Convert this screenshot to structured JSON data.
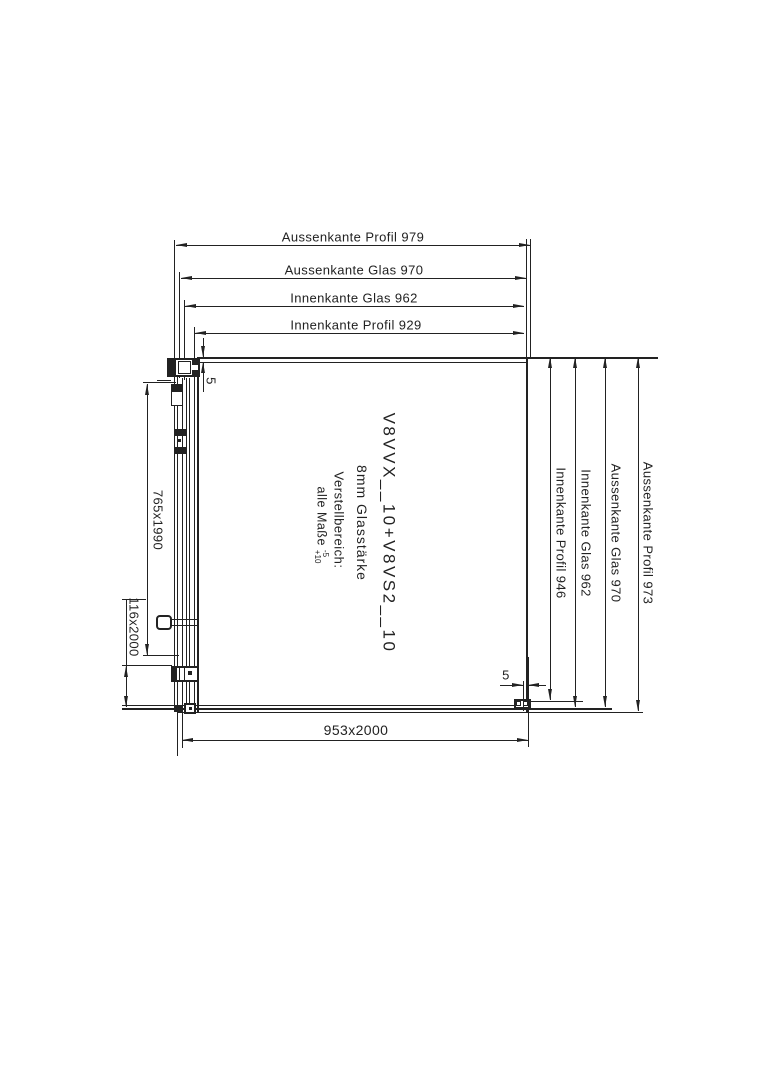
{
  "drawing": {
    "top_dimensions": [
      {
        "label": "Aussenkante Profil 979"
      },
      {
        "label": "Aussenkante Glas 970"
      },
      {
        "label": "Innenkante Glas 962"
      },
      {
        "label": "Innenkante Profil 929"
      }
    ],
    "right_dimensions": [
      {
        "label": "Innenkante Profil 946"
      },
      {
        "label": "Innenkante Glas 962"
      },
      {
        "label": "Aussenkante Glas 970"
      },
      {
        "label": "Aussenkante Profil 973"
      }
    ],
    "left_dimensions": [
      {
        "label": "765x1990"
      },
      {
        "label": "116x2000"
      }
    ],
    "bottom_dimension": {
      "label": "953x2000"
    },
    "gap_dimensions": {
      "top_left": "5",
      "bottom_right": "5"
    },
    "center_text": {
      "model": "V8VVX__10+V8VS2__10",
      "glass": "8mm Glasstärke",
      "adjustment_title": "Verstellbereich:",
      "adjustment_note": "alle Maße",
      "tolerance_minus": "-5",
      "tolerance_plus": "+10"
    },
    "line_color": "#222222"
  }
}
